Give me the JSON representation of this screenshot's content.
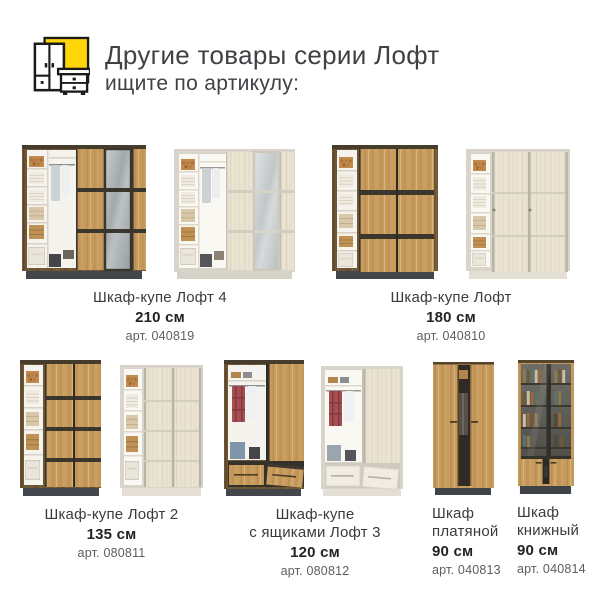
{
  "header": {
    "title": "Другие товары серии Лофт",
    "subtitle": "ищите по артикулу:",
    "logo_icon": "wardrobe-dresser-icon",
    "accent_color": "#FFD60A"
  },
  "products": [
    {
      "name": "Шкаф-купе Лофт 4",
      "size": "210 см",
      "article": "арт. 040819"
    },
    {
      "name": "Шкаф-купе Лофт",
      "size": "180 см",
      "article": "арт. 040810"
    },
    {
      "name": "Шкаф-купе Лофт 2",
      "size": "135 см",
      "article": "арт. 080811"
    },
    {
      "name": "Шкаф-купе\nс ящиками Лофт 3",
      "size": "120 см",
      "article": "арт. 080812"
    },
    {
      "name": "Шкаф\nплатяной",
      "size": "90 см",
      "article": "арт. 040813"
    },
    {
      "name": "Шкаф\nкнижный",
      "size": "90 см",
      "article": "арт. 040814"
    }
  ],
  "colors": {
    "accent_yellow": "#FFD60A",
    "title_text": "#414045",
    "name_text": "#3B3B3F",
    "size_text": "#232327",
    "article_text": "#5D5D62",
    "oak_wood": "#C69B5D",
    "walnut_frame": "#6E5635",
    "light_frame": "#D9D4C9",
    "birch_door": "#EAE3D2",
    "mirror_gray": "#A2A9AC",
    "plinth_dark": "#43464A"
  }
}
